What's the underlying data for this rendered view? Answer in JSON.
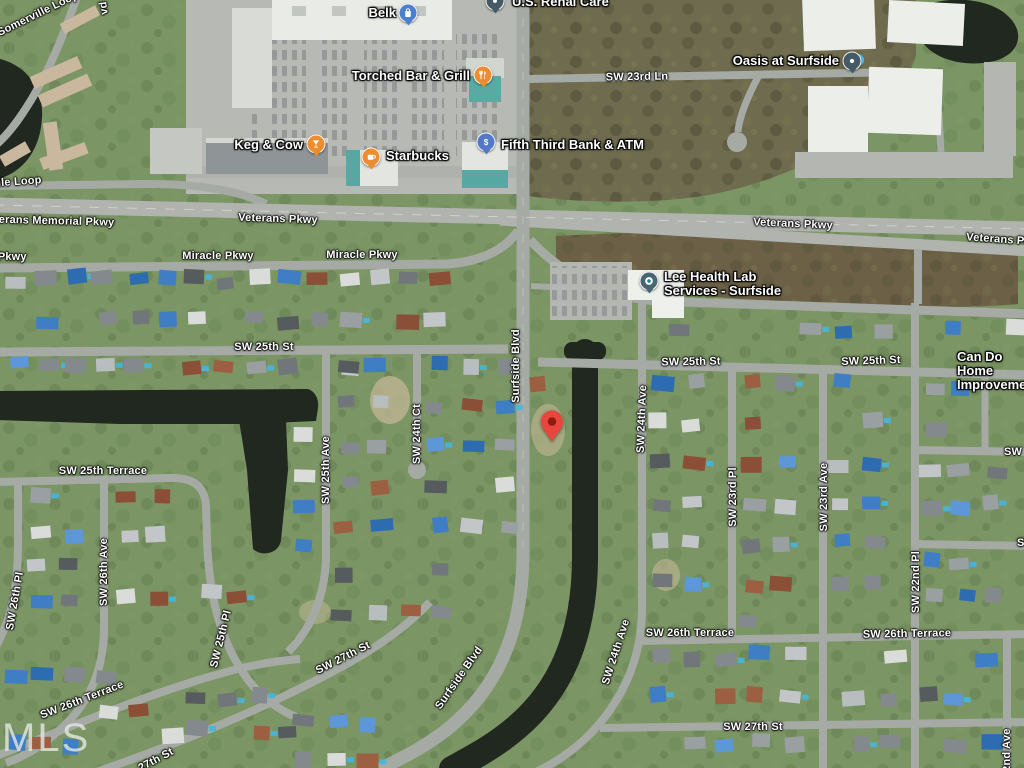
{
  "map": {
    "attribution_watermark": "MLS",
    "destination_pin": {
      "x": 552,
      "y": 448,
      "color": "#E8453C",
      "dot_color": "#8F1A10"
    }
  },
  "map_colors": {
    "grass": "#7C9565",
    "water": "#20281F",
    "road": "#A6AAA5",
    "highway": "#B0B3AE",
    "woods": "#6E6B4E",
    "field": "#6B5E45",
    "commercial_lot": "#B7BAB4",
    "building": "#ECEEE9"
  },
  "poi_markers": [
    {
      "name": "us-renal-care",
      "label": "U.S. Renal Care",
      "icon": "medical-pin-icon",
      "color": "#455A64",
      "x": 495,
      "y": 1,
      "label_side": "right",
      "lx": 512,
      "ly": 2
    },
    {
      "name": "belk",
      "label": "Belk",
      "icon": "shopping-bag-icon",
      "color": "#4D7FD0",
      "x": 408,
      "y": 13,
      "label_side": "left",
      "lx": 396,
      "ly": 13
    },
    {
      "name": "torched-bar-and-grill",
      "label": "Torched Bar & Grill",
      "icon": "restaurant-icon",
      "color": "#EE8C30",
      "x": 483,
      "y": 75,
      "label_side": "left",
      "lx": 470,
      "ly": 76
    },
    {
      "name": "keg-and-cow",
      "label": "Keg & Cow",
      "icon": "bar-icon",
      "color": "#EE8C30",
      "x": 316,
      "y": 144,
      "label_side": "left",
      "lx": 303,
      "ly": 145
    },
    {
      "name": "starbucks",
      "label": "Starbucks",
      "icon": "coffee-cup-icon",
      "color": "#EE8C30",
      "x": 371,
      "y": 157,
      "label_side": "right",
      "lx": 386,
      "ly": 156
    },
    {
      "name": "fifth-third-bank-atm",
      "label": "Fifth Third Bank & ATM",
      "icon": "dollar-icon",
      "color": "#5377C9",
      "x": 486,
      "y": 142,
      "label_side": "right",
      "lx": 501,
      "ly": 145
    },
    {
      "name": "oasis-at-surfside",
      "label": "Oasis at Surfside",
      "icon": "place-dot-icon",
      "color": "#455A64",
      "x": 852,
      "y": 61,
      "label_side": "left",
      "lx": 839,
      "ly": 61
    },
    {
      "name": "lee-health-lab-services",
      "label": "Lee Health Lab\nServices - Surfside",
      "icon": "health-pin-icon",
      "color": "#4A6572",
      "x": 649,
      "y": 281,
      "label_side": "right",
      "lx": 664,
      "ly": 284
    },
    {
      "name": "can-do-home-improvement",
      "label": "Can Do Home\nImprovement",
      "icon": null,
      "color": null,
      "x": null,
      "y": null,
      "label_side": "right",
      "lx": 957,
      "ly": 371
    }
  ],
  "road_labels": [
    {
      "name": "somerville-loop",
      "text": "Somerville Loop",
      "x": 38,
      "y": 14,
      "rot": -26
    },
    {
      "name": "blvd-partial",
      "text": "vd",
      "x": 104,
      "y": 8,
      "rot": -97
    },
    {
      "name": "ville-loop",
      "text": "ville Loop",
      "x": 15,
      "y": 182,
      "rot": -4
    },
    {
      "name": "veterans-memorial-pkwy",
      "text": "Veterans Memorial Pkwy",
      "x": 48,
      "y": 221,
      "rot": 1.5
    },
    {
      "name": "veterans-pkwy-1",
      "text": "Veterans Pkwy",
      "x": 278,
      "y": 219,
      "rot": 2
    },
    {
      "name": "veterans-pkwy-2",
      "text": "Veterans Pkwy",
      "x": 793,
      "y": 224,
      "rot": 2.5
    },
    {
      "name": "veterans-pkwy-3",
      "text": "Veterans Pkwy",
      "x": 1006,
      "y": 240,
      "rot": 4
    },
    {
      "name": "miracle-pkwy-partial",
      "text": "Miracle Pkwy",
      "x": -9,
      "y": 257,
      "rot": 0
    },
    {
      "name": "miracle-pkwy-1",
      "text": "Miracle Pkwy",
      "x": 218,
      "y": 256,
      "rot": 0
    },
    {
      "name": "miracle-pkwy-2",
      "text": "Miracle Pkwy",
      "x": 362,
      "y": 255,
      "rot": 0
    },
    {
      "name": "sw-23rd-ln",
      "text": "SW 23rd Ln",
      "x": 637,
      "y": 77,
      "rot": -1
    },
    {
      "name": "sw-25th-st-1",
      "text": "SW 25th St",
      "x": 264,
      "y": 347,
      "rot": 0
    },
    {
      "name": "sw-25th-st-2",
      "text": "SW 25th St",
      "x": 691,
      "y": 362,
      "rot": -1
    },
    {
      "name": "sw-25th-st-3",
      "text": "SW 25th St",
      "x": 871,
      "y": 361,
      "rot": -2
    },
    {
      "name": "surfside-blvd-north",
      "text": "Surfside Blvd",
      "x": 516,
      "y": 366,
      "rot": -90
    },
    {
      "name": "sw-24th-ct",
      "text": "SW 24th Ct",
      "x": 417,
      "y": 434,
      "rot": -90
    },
    {
      "name": "sw-25th-ave",
      "text": "SW 25th Ave",
      "x": 326,
      "y": 470,
      "rot": -90
    },
    {
      "name": "sw-24th-ave-north",
      "text": "SW 24th Ave",
      "x": 642,
      "y": 419,
      "rot": -88
    },
    {
      "name": "sw-25th-terrace",
      "text": "SW 25th Terrace",
      "x": 103,
      "y": 471,
      "rot": 0
    },
    {
      "name": "sw-23rd-pl",
      "text": "SW 23rd Pl",
      "x": 733,
      "y": 497,
      "rot": -90
    },
    {
      "name": "sw-23rd-ave",
      "text": "SW 23rd Ave",
      "x": 824,
      "y": 497,
      "rot": -90
    },
    {
      "name": "sw-22nd-pl",
      "text": "SW 22nd Pl",
      "x": 916,
      "y": 582,
      "rot": -90
    },
    {
      "name": "sw-partial-1",
      "text": "SW",
      "x": 1013,
      "y": 452,
      "rot": 0
    },
    {
      "name": "sw-partial-2",
      "text": "SW",
      "x": 1026,
      "y": 543,
      "rot": 0
    },
    {
      "name": "sw-26th-ave",
      "text": "SW 26th Ave",
      "x": 104,
      "y": 572,
      "rot": -90
    },
    {
      "name": "sw-26th-pl",
      "text": "SW 26th Pl",
      "x": 15,
      "y": 601,
      "rot": -80
    },
    {
      "name": "sw-26th-terrace-sw",
      "text": "SW 26th Terrace",
      "x": 82,
      "y": 700,
      "rot": -21
    },
    {
      "name": "sw-25th-pl",
      "text": "SW 25th Pl",
      "x": 221,
      "y": 639,
      "rot": -76
    },
    {
      "name": "sw-27th-st-sw",
      "text": "SW 27th St",
      "x": 343,
      "y": 658,
      "rot": -27
    },
    {
      "name": "surfside-blvd-south",
      "text": "Surfside Blvd",
      "x": 459,
      "y": 678,
      "rot": -55
    },
    {
      "name": "sw-24th-ave-south",
      "text": "SW 24th Ave",
      "x": 616,
      "y": 652,
      "rot": -72
    },
    {
      "name": "sw-26th-terrace-1",
      "text": "SW 26th Terrace",
      "x": 690,
      "y": 633,
      "rot": 0
    },
    {
      "name": "sw-26th-terrace-2",
      "text": "SW 26th Terrace",
      "x": 907,
      "y": 634,
      "rot": -1
    },
    {
      "name": "sw-27th-st-1",
      "text": "SW 27th St",
      "x": 753,
      "y": 727,
      "rot": 0
    },
    {
      "name": "sw-27th-st-partial",
      "text": "27th St",
      "x": 156,
      "y": 760,
      "rot": -28
    },
    {
      "name": "sw-22nd-ave",
      "text": "SW 22nd Ave",
      "x": 1007,
      "y": 764,
      "rot": -90
    }
  ]
}
